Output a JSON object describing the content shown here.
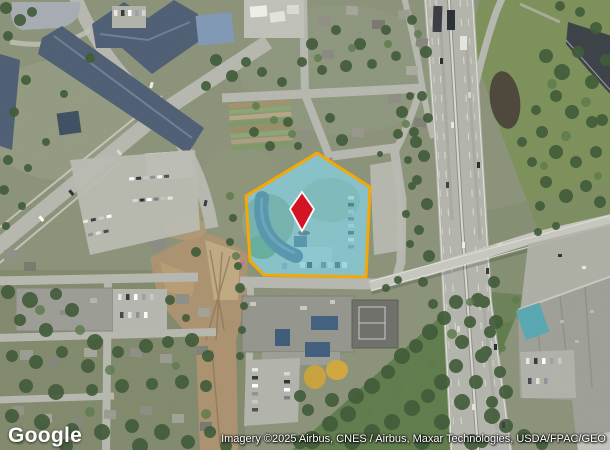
{
  "branding": {
    "logo_text": "Google"
  },
  "attribution": {
    "text": "Imagery ©2025 Airbus, CNES / Airbus, Maxar Technologies, USDA/FPAC/GEO"
  },
  "overlay": {
    "parcel_fill_color": "#5BC4D8",
    "parcel_border_color": "#F5A800",
    "marker_color": "#D40F1F",
    "marker_outline_color": "#FFFFFF"
  }
}
